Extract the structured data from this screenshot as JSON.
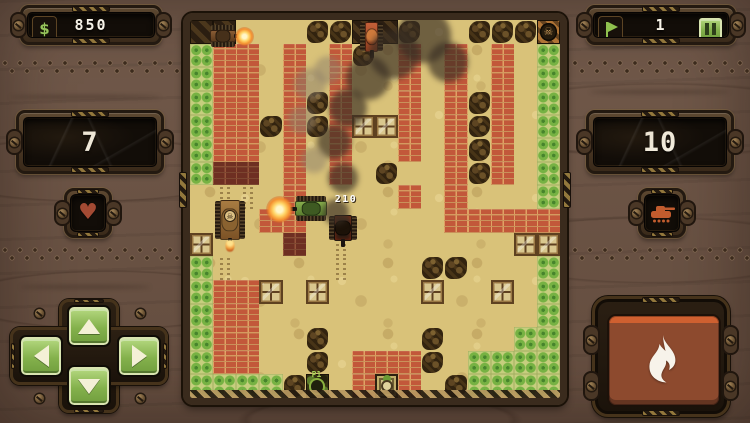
{
  "hud": {
    "money": {
      "symbol": "$",
      "value": "850",
      "icon": "dollar-icon"
    },
    "stage": {
      "value": "1",
      "icon": "flag-icon"
    },
    "pause": {
      "icon": "pause-icon"
    },
    "lives": {
      "value": "7",
      "icon": "heart-icon",
      "icon_glyph": "♥"
    },
    "enemies": {
      "value": "10",
      "icon": "tank-icon"
    }
  },
  "controls": {
    "dpad_icons": [
      "arrow-up-icon",
      "arrow-down-icon",
      "arrow-left-icon",
      "arrow-right-icon"
    ],
    "fire_icon": "flame-icon"
  },
  "battlefield": {
    "damage_popup": "210",
    "spawn_point_label": "P1",
    "legend": {
      "B": "brick-wall",
      "R": "damaged-brick-wall",
      "T": "trees",
      "C": "crate",
      "D": "hazard-tile",
      "b": "scrub-bush",
      "K": "enemy-spawn-skull-tile",
      "P": "player-spawn-tile",
      "H": "base-tile",
      "t": "track-marks",
      ".": "sand"
    },
    "grid": [
      "DD...bbDDb..bbbK",
      "TBB.B.Bb.B.B.B.T",
      "TBB.B.B..B.B.B.T",
      "TBB.BbB..B.BbB.T",
      "TBBbBbBCCB.BbB.T",
      "TBB.B.B..B.BbB.T",
      "TRR.B.B.b..BbB.T",
      ".tt.B....B.B...T",
      "...BB......BBBBB",
      "C...R.t.......CC",
      "Tt....t...bb...T",
      "TBBC.C....C..C.T",
      "TBB............T",
      "TBB..b....b...TT",
      "TBB..b.BBBb.TTTT",
      "TTTTbP.BHB.bTTTT"
    ],
    "tanks": [
      {
        "id": "enemy-tank-1",
        "color": "brown",
        "facing": "right",
        "x": 20,
        "y": 5,
        "w": 26,
        "h": 22
      },
      {
        "id": "enemy-tank-2",
        "color": "orange",
        "facing": "down",
        "x": 170,
        "y": 2,
        "w": 23,
        "h": 30
      },
      {
        "id": "enemy-tank-skull",
        "color": "tan",
        "facing": "down",
        "x": 25,
        "y": 180,
        "w": 30,
        "h": 40,
        "badge": "skull-icon",
        "exhaust": true
      },
      {
        "id": "player-tank",
        "color": "green",
        "facing": "left",
        "x": 105,
        "y": 176,
        "w": 32,
        "h": 25
      },
      {
        "id": "wrecked-burning-tank",
        "color": "dark",
        "facing": "down",
        "x": 139,
        "y": 195,
        "w": 28,
        "h": 26
      }
    ],
    "muzzle_flashes": [
      {
        "x": 76,
        "y": 176,
        "size": 27
      },
      {
        "x": 45,
        "y": 7,
        "size": 19
      }
    ],
    "smoke": [
      {
        "x": 146,
        "y": 192,
        "r": 13,
        "tone": "dark"
      },
      {
        "x": 153,
        "y": 158,
        "r": 15,
        "tone": "dark"
      },
      {
        "x": 144,
        "y": 122,
        "r": 17,
        "tone": "dark"
      },
      {
        "x": 158,
        "y": 88,
        "r": 19,
        "tone": "dark"
      },
      {
        "x": 178,
        "y": 58,
        "r": 22,
        "tone": "dark"
      },
      {
        "x": 204,
        "y": 34,
        "r": 25,
        "tone": "dark"
      },
      {
        "x": 234,
        "y": 16,
        "r": 27,
        "tone": "dark"
      },
      {
        "x": 258,
        "y": 42,
        "r": 20,
        "tone": "dark"
      },
      {
        "x": 120,
        "y": 64,
        "r": 16,
        "tone": "light"
      },
      {
        "x": 112,
        "y": 100,
        "r": 14,
        "tone": "light"
      },
      {
        "x": 124,
        "y": 140,
        "r": 13,
        "tone": "light"
      },
      {
        "x": 138,
        "y": 50,
        "r": 14,
        "tone": "light"
      }
    ]
  },
  "colors": {
    "wood": "#6b5447",
    "panel_frame": "#4e3b27",
    "screen": "#120d08",
    "accent_green": "#8fc04e",
    "brick": "#c2583a",
    "sand": "#d9c279",
    "tree_green": "#76b243",
    "fire_button": "#8d4a2e",
    "fire_accent": "#cf6030",
    "heart": "#a34a33",
    "tank_icon": "#c25c2e",
    "damage_text": "#ffffff"
  }
}
